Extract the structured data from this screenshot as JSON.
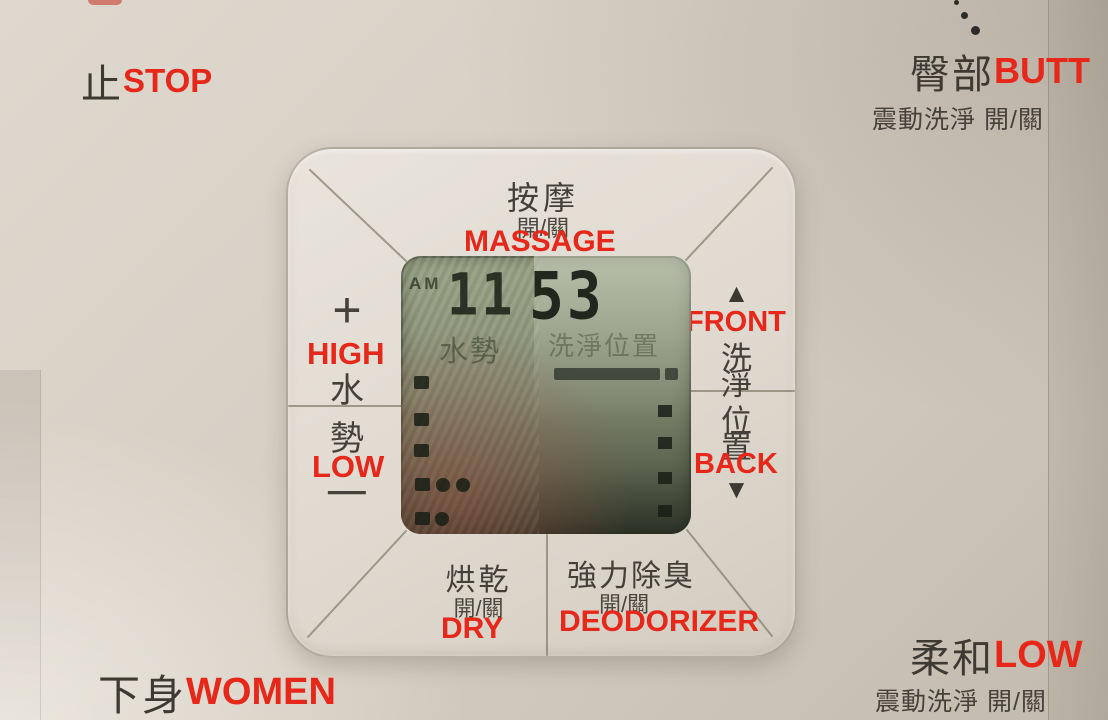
{
  "scene": {
    "description": "Bidet washlet control panel photo with red English annotations"
  },
  "colors": {
    "annotation_red": "#e8271b",
    "panel_beige": "#d6cfc4",
    "pad_face": "#e3ded5",
    "lcd_green": "#8d9679",
    "text_dark": "#403d36"
  },
  "icons": {
    "up_arrow": "▲",
    "down_arrow": "▼",
    "plus": "+",
    "minus": "−",
    "dots": "vertical-dots"
  },
  "corner_buttons": {
    "stop": {
      "zh": "止",
      "en": "STOP"
    },
    "butt": {
      "zh": "臀部",
      "en": "BUTT",
      "sub": "震動洗淨 開/關"
    },
    "women": {
      "zh": "下身",
      "en": "WOMEN"
    },
    "soft": {
      "zh": "柔和",
      "en": "LOW",
      "sub": "震動洗淨 開/關"
    }
  },
  "pad": {
    "massage": {
      "zh": "按摩",
      "onoff": "開/關",
      "en": "MASSAGE"
    },
    "pressure": {
      "up_en": "HIGH",
      "char1": "水",
      "char2": "勢",
      "down_en": "LOW"
    },
    "position": {
      "up_en": "FRONT",
      "char1": "洗",
      "char2": "淨",
      "char3": "位",
      "char4": "置",
      "down_en": "BACK"
    },
    "dry": {
      "zh": "烘乾",
      "onoff": "開/關",
      "en": "DRY"
    },
    "deodorizer": {
      "zh": "強力除臭",
      "onoff": "開/關",
      "en": "DEODORIZER"
    }
  },
  "lcd": {
    "meridiem": "AM",
    "hours": "11",
    "minutes": "53",
    "pressure_label": "水勢",
    "position_label": "洗淨位置",
    "left_indicator_count": 5,
    "right_indicator_count": 4
  }
}
